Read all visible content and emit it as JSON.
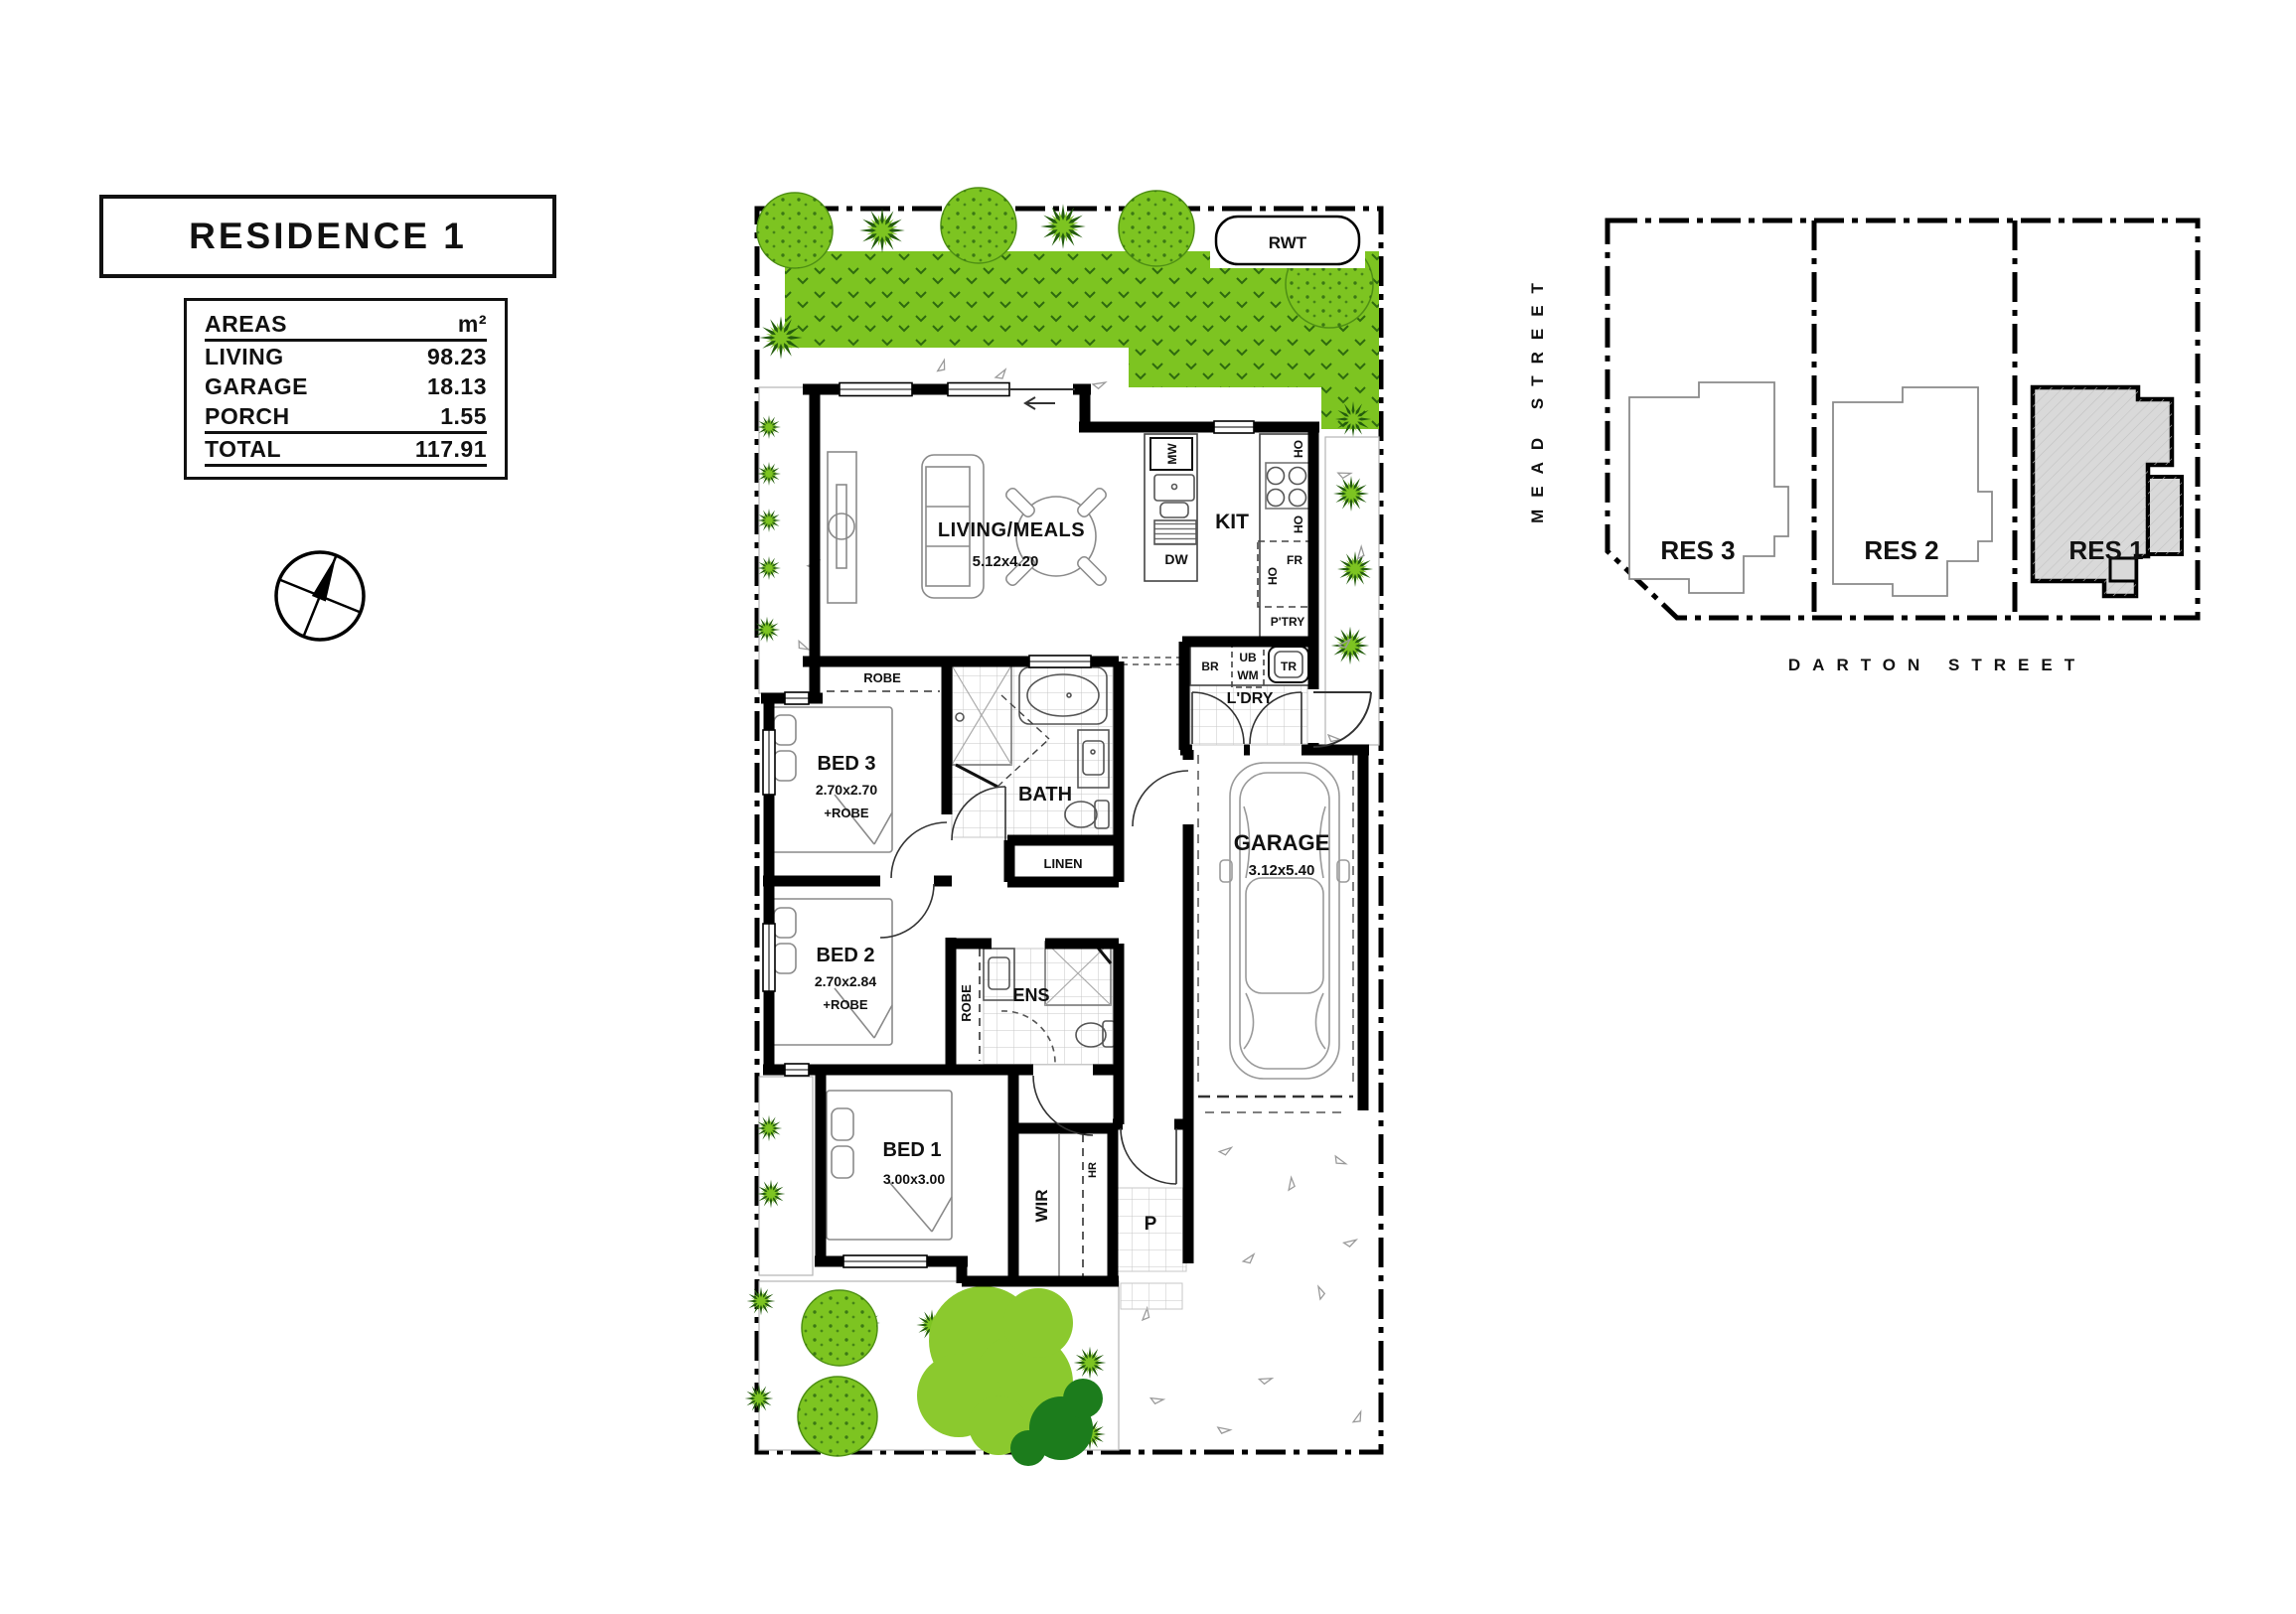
{
  "title": "RESIDENCE 1",
  "areas": {
    "header": {
      "label": "AREAS",
      "unit": "m²"
    },
    "rows": [
      {
        "label": "LIVING",
        "value": "98.23"
      },
      {
        "label": "GARAGE",
        "value": "18.13"
      },
      {
        "label": "PORCH",
        "value": "1.55"
      }
    ],
    "total": {
      "label": "TOTAL",
      "value": "117.91"
    }
  },
  "floor_plan": {
    "rwt": "RWT",
    "living": {
      "name": "LIVING/MEALS",
      "dims": "5.12x4.20"
    },
    "kitchen": {
      "name": "KIT",
      "mw": "MW",
      "dw": "DW",
      "ho": "HO",
      "fr": "FR",
      "pantry": "P'TRY"
    },
    "laundry": {
      "name": "L'DRY",
      "br": "BR",
      "ub": "UB",
      "wm": "WM",
      "tr": "TR"
    },
    "robe_label": "ROBE",
    "bed3": {
      "name": "BED 3",
      "dims": "2.70x2.70",
      "robe": "+ROBE"
    },
    "bed2": {
      "name": "BED 2",
      "dims": "2.70x2.84",
      "robe": "+ROBE"
    },
    "bed1": {
      "name": "BED 1",
      "dims": "3.00x3.00"
    },
    "bath": {
      "name": "BATH"
    },
    "linen": "LINEN",
    "ens": "ENS",
    "wir": {
      "name": "WIR",
      "hr": "HR"
    },
    "garage": {
      "name": "GARAGE",
      "dims": "3.12x5.40"
    },
    "porch": "P"
  },
  "site_plan": {
    "residences": [
      {
        "label": "RES 3",
        "highlighted": false
      },
      {
        "label": "RES 2",
        "highlighted": false
      },
      {
        "label": "RES 1",
        "highlighted": true
      }
    ],
    "streets": {
      "left": "MEAD STREET",
      "bottom": "DARTON STREET"
    }
  },
  "colors": {
    "grass": "#7dc421",
    "grass_detail": "#2e6a0e",
    "tree_light": "#8bc92e",
    "tree_dark": "#1c7c1c",
    "wall": "#000000",
    "res1_fill": "#d9d9d9",
    "outline_gray": "#8a8a8a"
  }
}
